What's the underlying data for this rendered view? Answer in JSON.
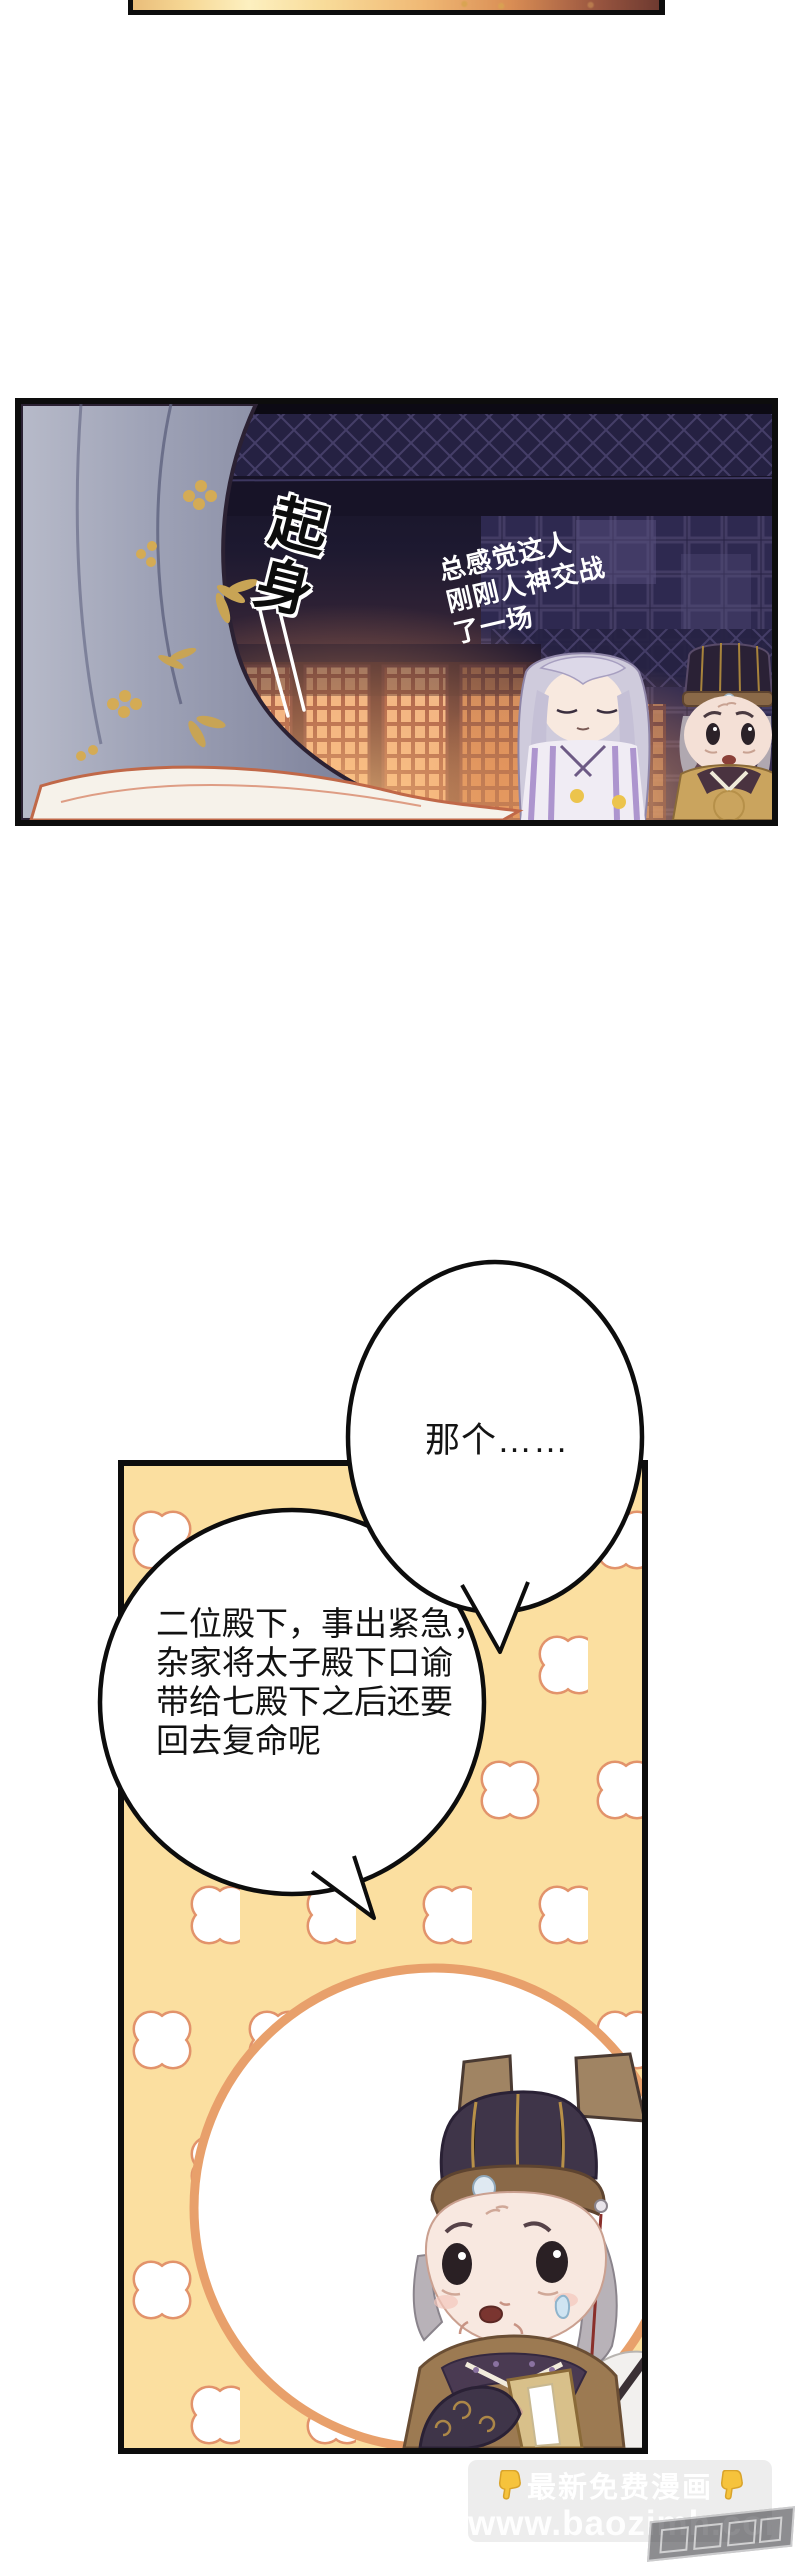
{
  "dark_panel": {
    "sfx": "起身",
    "narration_lines": [
      "总感觉这人",
      "刚刚人神交战",
      "了一场"
    ]
  },
  "yellow_panel": {
    "bubble_small": {
      "text": "那个……"
    },
    "bubble_large": {
      "lines": [
        "二位殿下，事出紧急，",
        "杂家将太子殿下口谕",
        "带给七殿下之后还要",
        "回去复命呢"
      ]
    }
  },
  "watermark": {
    "promo_line": "最新免费漫画",
    "site_line": "www.baozimh.com"
  },
  "colors": {
    "panel_border": "#0d0d0d",
    "yellow_bg": "#FBDFA0",
    "clover_stroke": "#E2936B",
    "inset_ring": "#E8A06B",
    "glow_orange": "#E8956A",
    "hand_yellow": "#F6C33C",
    "narration_white": "#FFFFFF"
  }
}
